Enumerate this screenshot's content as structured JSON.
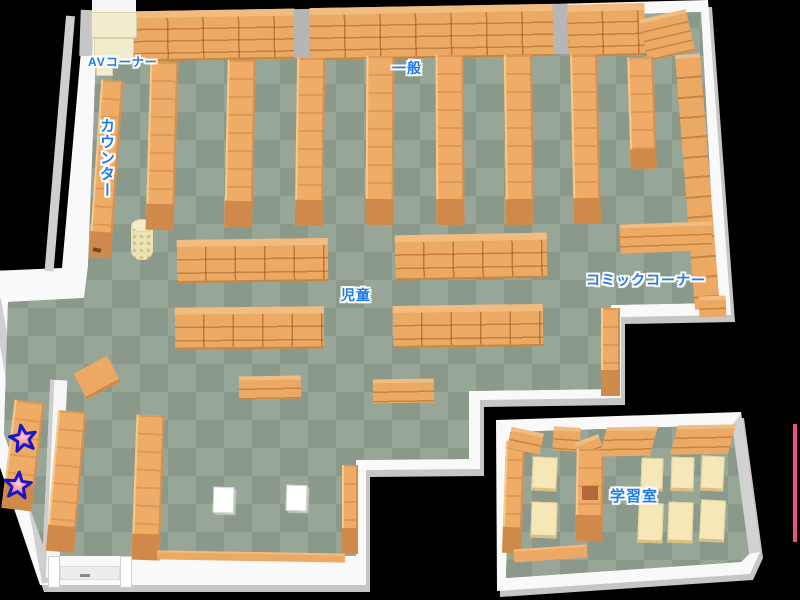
{
  "map_type": "library-floor-map",
  "labels": {
    "av_corner": "AVコーナー",
    "counter": "カウンター",
    "general": "一般",
    "children": "児童",
    "comic_corner": "コミックコーナー",
    "study_room": "学習室"
  },
  "markers": [
    {
      "icon": "star",
      "fill": "#ff8b96",
      "outline": "#1717c9"
    },
    {
      "icon": "star",
      "fill": "#ff8b96",
      "outline": "#1717c9"
    }
  ],
  "colors": {
    "background": "#000000",
    "label_text": "#1e7bf0",
    "label_outline": "#ffffff",
    "floor_light": "#98a698",
    "floor_dark": "#8b998b",
    "wall": "#f9f9f9",
    "shelf": "#eca963",
    "shelf_base": "#cf8a4b",
    "furniture_cream": "#f6e7b9",
    "av_furniture": "#f2ecce",
    "boundary_line": "#f0508a"
  }
}
